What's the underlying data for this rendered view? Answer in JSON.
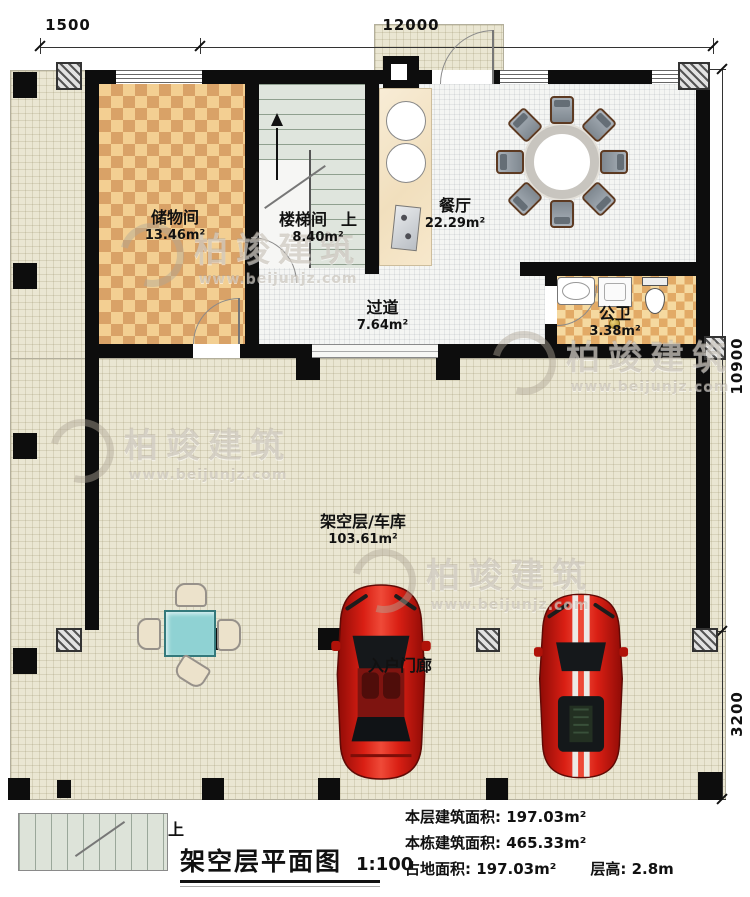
{
  "title_block": {
    "up": "上",
    "title": "架空层平面图",
    "scale": "1:100"
  },
  "stats": [
    {
      "label": "本层建筑面积:",
      "value": "197.03m²"
    },
    {
      "label": "本栋建筑面积:",
      "value": "465.33m²"
    },
    {
      "label": "占地面积:",
      "value": "197.03m²"
    },
    {
      "label": "层高:",
      "value": "2.8m"
    }
  ],
  "dimensions": {
    "top_left": "1500",
    "top_main": "12000",
    "right_upper": "10900",
    "right_lower": "3200"
  },
  "rooms": {
    "storage": {
      "name": "储物间",
      "area": "13.46m²"
    },
    "stair": {
      "name": "楼梯间",
      "area": "8.40m²",
      "up": "上"
    },
    "dining": {
      "name": "餐厅",
      "area": "22.29m²"
    },
    "corridor": {
      "name": "过道",
      "area": "7.64m²"
    },
    "bath": {
      "name": "公卫",
      "area": "3.38m²"
    },
    "garage": {
      "name": "架空层/车库",
      "area": "103.61m²"
    },
    "porch": {
      "name": "入户门廊"
    }
  },
  "watermark": {
    "brand": "柏竣建筑",
    "url": "www.beijunjz.com"
  },
  "colors": {
    "wall": "#0d0d0d",
    "car_red": "#c8150e",
    "table_teal": "#8fd2d3",
    "checker_dark": "#d9a267",
    "checker_light": "#f3cf92"
  }
}
